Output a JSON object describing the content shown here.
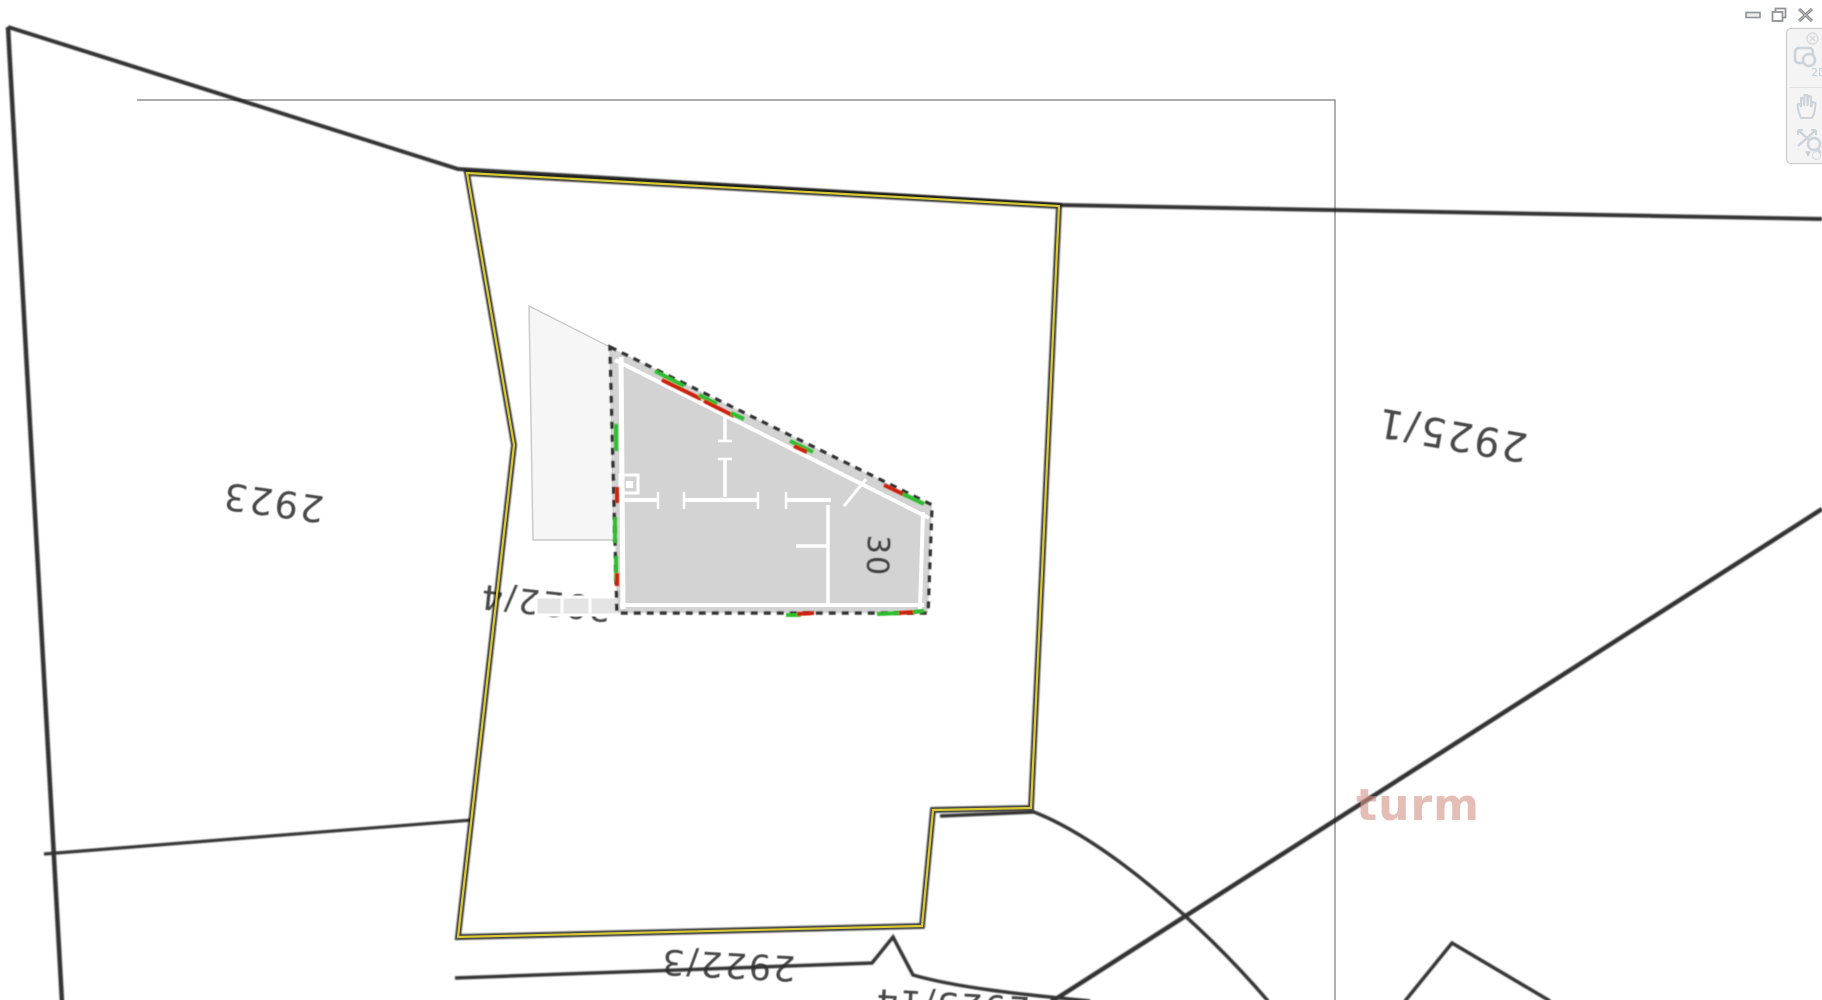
{
  "window_controls": {
    "items": [
      {
        "name": "minimize"
      },
      {
        "name": "restore"
      },
      {
        "name": "close"
      }
    ]
  },
  "nav_toolbar": {
    "tools": [
      {
        "name": "zoom-2d",
        "badge": "2D"
      },
      {
        "name": "pan-hand"
      },
      {
        "name": "zoom-extents"
      },
      {
        "name": "more",
        "glyph": "▾"
      }
    ]
  },
  "map": {
    "background": "#ffffff",
    "selected_parcel_outline_color": "#d9c931",
    "parcel_labels": [
      {
        "text": "2923",
        "x": 273,
        "y": 502,
        "size": 37,
        "rot": 188
      },
      {
        "text": "2925/1",
        "x": 1452,
        "y": 434,
        "size": 40,
        "rot": 190
      },
      {
        "text": "2922/4",
        "x": 545,
        "y": 602,
        "size": 34,
        "rot": 186
      },
      {
        "text": "2922/3",
        "x": 728,
        "y": 964,
        "size": 35,
        "rot": 183
      },
      {
        "text": "2925/14",
        "x": 952,
        "y": 1004,
        "size": 34,
        "rot": 183
      }
    ],
    "building": {
      "house_number": "30",
      "fill": "#d3d3d3"
    },
    "marker_colors": {
      "green": "#2fbf2f",
      "red": "#cf2410"
    }
  },
  "watermark": {
    "text": "turm",
    "logo": "3D",
    "logo_bg": "#cd2a21"
  }
}
